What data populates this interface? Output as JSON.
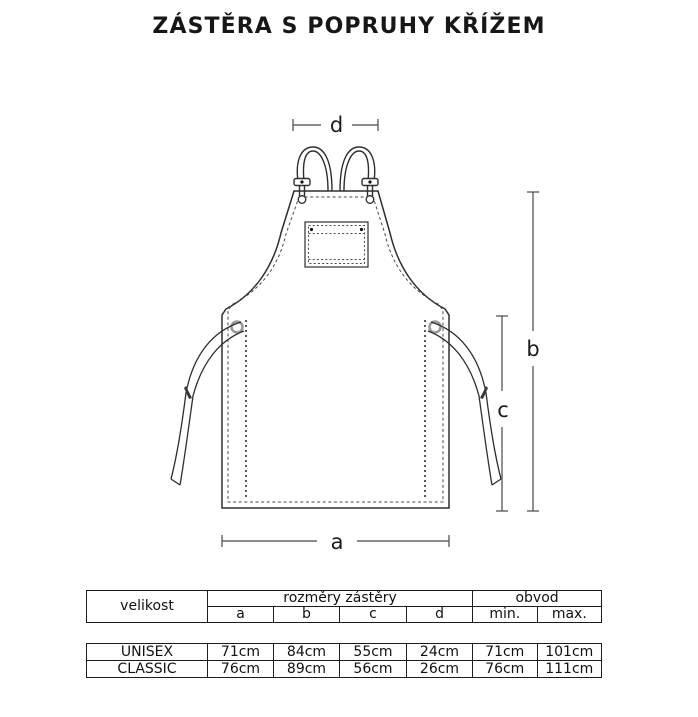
{
  "title": "ZÁSTĚRA S POPRUHY KŘÍŽEM",
  "diagram": {
    "labels": {
      "a": "a",
      "b": "b",
      "c": "c",
      "d": "d"
    },
    "line_color": "#2e2e2e",
    "grommet_color": "#9a9a9a"
  },
  "size_table": {
    "header": {
      "size_label": "velikost",
      "dimensions_label": "rozměry zástěry",
      "circumference_label": "obvod",
      "dimension_cols": [
        "a",
        "b",
        "c",
        "d"
      ],
      "min_label": "min.",
      "max_label": "max."
    },
    "rows": [
      {
        "name": "UNISEX",
        "a": "71cm",
        "b": "84cm",
        "c": "55cm",
        "d": "24cm",
        "min": "71cm",
        "max": "101cm"
      },
      {
        "name": "CLASSIC",
        "a": "76cm",
        "b": "89cm",
        "c": "56cm",
        "d": "26cm",
        "min": "76cm",
        "max": "111cm"
      }
    ]
  }
}
